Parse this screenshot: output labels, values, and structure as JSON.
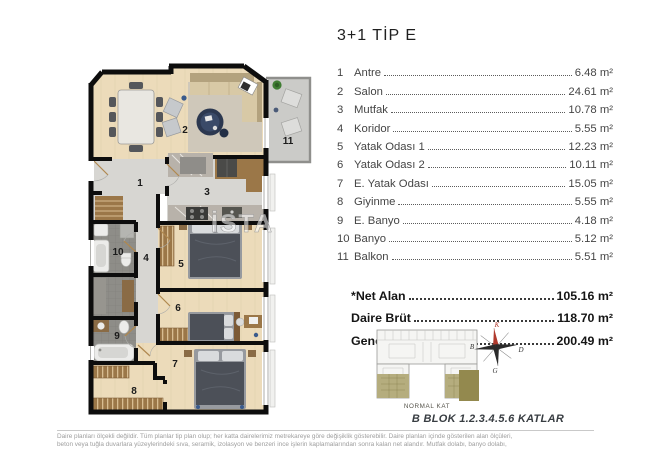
{
  "title": "3+1 TİP E",
  "rooms": [
    {
      "no": "1",
      "name": "Antre",
      "area": "6.48 m²"
    },
    {
      "no": "2",
      "name": "Salon",
      "area": "24.61 m²"
    },
    {
      "no": "3",
      "name": "Mutfak",
      "area": "10.78 m²"
    },
    {
      "no": "4",
      "name": "Koridor",
      "area": "5.55 m²"
    },
    {
      "no": "5",
      "name": "Yatak Odası 1",
      "area": "12.23 m²"
    },
    {
      "no": "6",
      "name": "Yatak Odası 2",
      "area": "10.11 m²"
    },
    {
      "no": "7",
      "name": "E. Yatak Odası",
      "area": "15.05 m²"
    },
    {
      "no": "8",
      "name": "Giyinme",
      "area": "5.55 m²"
    },
    {
      "no": "9",
      "name": "E. Banyo",
      "area": "4.18 m²"
    },
    {
      "no": "10",
      "name": "Banyo",
      "area": "5.12 m²"
    },
    {
      "no": "11",
      "name": "Balkon",
      "area": "5.51 m²"
    }
  ],
  "totals": [
    {
      "label": "*Net Alan",
      "value": "105.16 m²"
    },
    {
      "label": "Daire Brüt",
      "value": "118.70 m²"
    },
    {
      "label": "Genel Brüt",
      "value": "200.49 m²"
    }
  ],
  "key_plan": {
    "label": "NORMAL KAT",
    "caption": "B BLOK 1.2.3.4.5.6 KATLAR",
    "highlight_color": "#93894e",
    "wing_color": "#b5ad7e"
  },
  "compass": {
    "north": "K",
    "south": "G",
    "east": "D",
    "west": "B",
    "north_color": "#b03a2e"
  },
  "watermark": "İSTA",
  "disclaimer": {
    "line1": "Daire planları ölçekli değildir. Tüm planlar tip plan olup; her katta dairelerimiz metrekareye göre değişiklik gösterebilir. Daire planları içinde gösterilen alan ölçüleri,",
    "line2": "beton veya tuğla duvarlara yüzeylerindeki sıva, seramik, izolasyon ve benzeri ince işlerin kaplamalarından sonra kalan net alandır. Mutfak dolabı, banyo dolabı,"
  },
  "colors": {
    "wall": "#0d0d0d",
    "wood_floor": "#ecdbba",
    "hard_floor": "#d7d6d2",
    "tile_floor": "#8e8d88",
    "balcony_floor": "#cbcbc8"
  }
}
